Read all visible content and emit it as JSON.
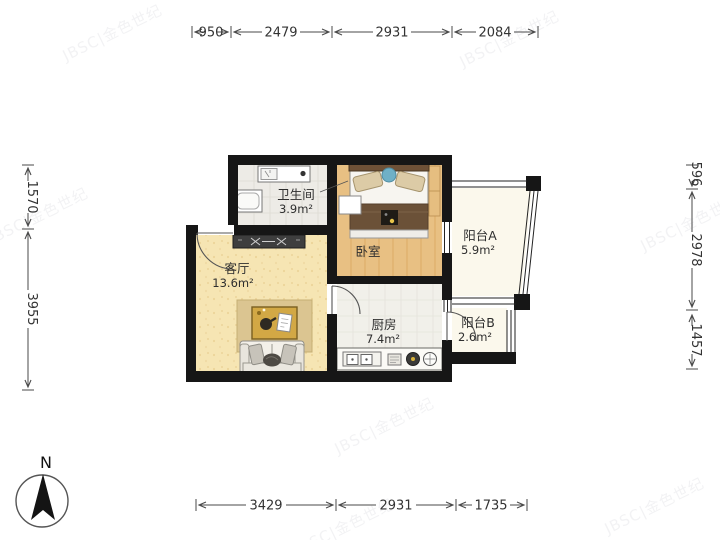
{
  "plan": {
    "rooms": [
      {
        "id": "bathroom",
        "name": "卫生间",
        "area": "3.9m²"
      },
      {
        "id": "bedroom",
        "name": "卧室",
        "area": ""
      },
      {
        "id": "balcony-a",
        "name": "阳台A",
        "area": "5.9m²"
      },
      {
        "id": "living",
        "name": "客厅",
        "area": "13.6m²"
      },
      {
        "id": "kitchen",
        "name": "厨房",
        "area": "7.4m²"
      },
      {
        "id": "balcony-b",
        "name": "阳台B",
        "area": "2.6m²"
      }
    ]
  },
  "dimensions": {
    "unit": "mm",
    "top": [
      "950",
      "2479",
      "2931",
      "2084"
    ],
    "bottom": [
      "3429",
      "2931",
      "1735"
    ],
    "left": [
      "1570",
      "3955"
    ],
    "right": [
      "596",
      "2978",
      "1457"
    ]
  },
  "compass": {
    "label": "N"
  },
  "watermark": {
    "text": "JBSC|金色世纪"
  },
  "colors": {
    "wall": "#161616",
    "wood_floor": "#e8c083",
    "living_floor": "#f6e5b3",
    "kitchen_floor": "#f1f0ea",
    "bathroom_floor": "#edebe6",
    "balcony_floor": "#fbf8ec",
    "dim_text": "#333333"
  }
}
